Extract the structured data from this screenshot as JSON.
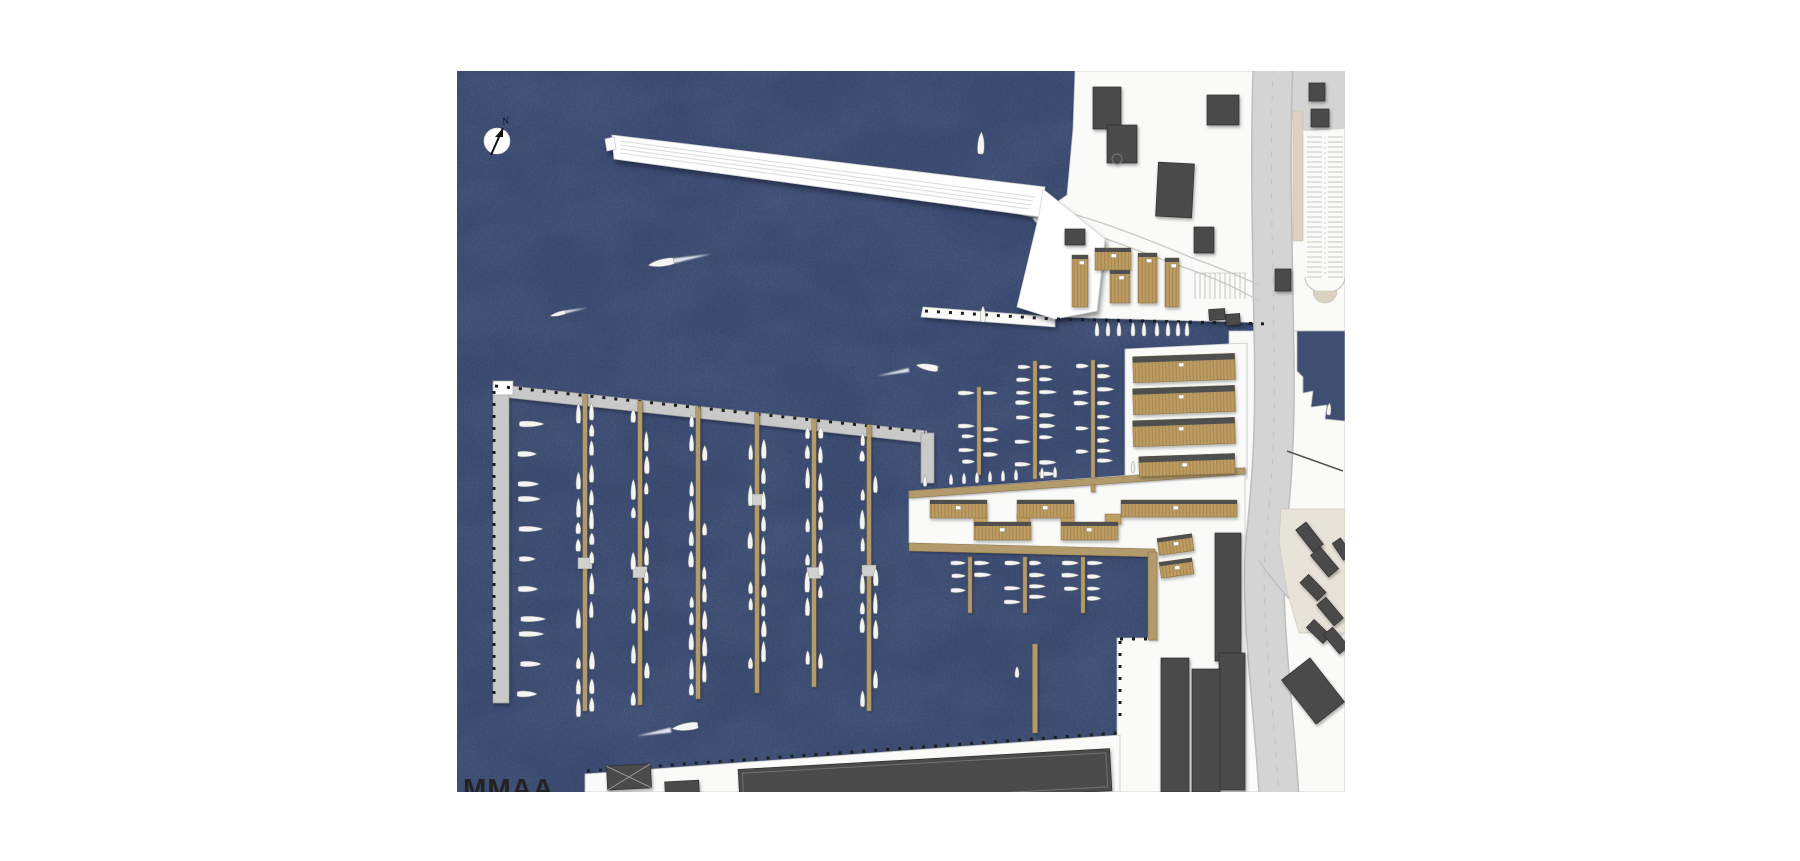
{
  "page": {
    "background": "#ffffff"
  },
  "plan": {
    "frame": {
      "left": 457,
      "top": 71,
      "width": 888,
      "height": 721
    },
    "logo": {
      "text": "MMAA"
    },
    "compass": {
      "label": "N"
    },
    "seed": 11,
    "colors": {
      "water": "#3e4f72",
      "land": "#fafaf8",
      "land_stroke": "#c6c6c6",
      "road": "#d4d4d4",
      "road_casing": "#bdbdbd",
      "lane": "#c8c8c8",
      "beige": "#dbd2c2",
      "plaza": "#e8e3d9",
      "dark": "#4a4a4a",
      "dark_stroke": "#2e2e2e",
      "wood": "#b29a6a",
      "wood_stroke": "#8a7349",
      "shed": "#bd9d62",
      "shed_top": "#4f4f4f",
      "gray_pier": "#c9c9c9",
      "gray_pier_stroke": "#9a9a9a",
      "boat": "#f4f4f2",
      "boat_stroke": "#8f8f8f",
      "platform": "#d0d0ce",
      "tick": "#1d1d1d",
      "white": "#ffffff"
    },
    "landforms": [
      {
        "name": "land-top-right",
        "points": [
          [
            618,
            0
          ],
          [
            888,
            0
          ],
          [
            888,
            262
          ],
          [
            816,
            262
          ],
          [
            816,
            252
          ],
          [
            598,
            246
          ],
          [
            590,
            234
          ],
          [
            590,
            200
          ],
          [
            602,
            176
          ],
          [
            576,
            148
          ],
          [
            610,
            124
          ],
          [
            616,
            58
          ]
        ]
      },
      {
        "name": "land-right-strip",
        "points": [
          [
            772,
            260
          ],
          [
            888,
            260
          ],
          [
            888,
            721
          ],
          [
            772,
            721
          ]
        ]
      },
      {
        "name": "land-shed-strip",
        "points": [
          [
            668,
            278
          ],
          [
            790,
            272
          ],
          [
            790,
            408
          ],
          [
            668,
            414
          ]
        ]
      },
      {
        "name": "land-peninsula",
        "points": [
          [
            452,
            420
          ],
          [
            788,
            396
          ],
          [
            788,
            721
          ],
          [
            660,
            721
          ],
          [
            660,
            567
          ],
          [
            698,
            567
          ],
          [
            698,
            481
          ],
          [
            452,
            472
          ]
        ]
      },
      {
        "name": "land-bottom-quay",
        "points": [
          [
            128,
            703
          ],
          [
            663,
            664
          ],
          [
            663,
            721
          ],
          [
            128,
            721
          ]
        ]
      },
      {
        "name": "quay-strip",
        "points": [
          [
            466,
            236
          ],
          [
            598,
            246
          ],
          [
            598,
            256
          ],
          [
            464,
            246
          ]
        ]
      }
    ],
    "water_inlet": {
      "points": [
        [
          840,
          260
        ],
        [
          888,
          260
        ],
        [
          888,
          350
        ],
        [
          868,
          348
        ],
        [
          870,
          334
        ],
        [
          854,
          336
        ],
        [
          856,
          320
        ],
        [
          846,
          322
        ],
        [
          846,
          306
        ],
        [
          840,
          300
        ]
      ]
    },
    "white_pier": {
      "bar": [
        [
          155,
          64
        ],
        [
          588,
          116
        ],
        [
          584,
          146
        ],
        [
          157,
          88
        ]
      ],
      "wedge": [
        [
          586,
          118
        ],
        [
          648,
          168
        ],
        [
          640,
          240
        ],
        [
          598,
          248
        ],
        [
          560,
          236
        ],
        [
          582,
          144
        ]
      ],
      "tip_notch": [
        [
          148,
          68
        ],
        [
          157,
          66
        ],
        [
          159,
          78
        ],
        [
          150,
          80
        ]
      ],
      "lanes": [
        [
          163,
          70,
          578,
          126
        ],
        [
          163,
          74,
          576,
          130
        ],
        [
          163,
          78,
          574,
          134
        ],
        [
          163,
          82,
          572,
          138
        ]
      ],
      "connector_lanes": [
        "M 560,130 C 620,140 680,164 733,186 C 760,196 785,206 802,214",
        "M 556,142 C 615,152 675,178 726,196 C 755,206 782,218 802,230"
      ]
    },
    "gray_breakwater": {
      "header": [
        [
          36,
          313
        ],
        [
          470,
          360
        ],
        [
          470,
          372
        ],
        [
          36,
          325
        ]
      ],
      "vertical": [
        [
          36,
          313
        ],
        [
          52,
          313
        ],
        [
          52,
          632
        ],
        [
          36,
          632
        ]
      ],
      "stub": [
        [
          464,
          362
        ],
        [
          477,
          362
        ],
        [
          477,
          412
        ],
        [
          464,
          412
        ]
      ],
      "cap": [
        [
          36,
          310
        ],
        [
          56,
          310
        ],
        [
          56,
          324
        ],
        [
          36,
          324
        ]
      ]
    },
    "quay_ticks": [
      [
        38,
        315,
        468,
        361
      ],
      [
        37,
        320,
        37,
        628
      ],
      [
        600,
        248,
        814,
        253
      ],
      [
        130,
        700,
        660,
        662
      ],
      [
        468,
        240,
        596,
        248
      ],
      [
        663,
        568,
        700,
        568
      ],
      [
        663,
        570,
        663,
        650
      ]
    ],
    "roads": {
      "main": "M 816,-4 C 813,80 815,160 817,270 C 819,368 814,420 808,478 C 804,545 816,630 822,724",
      "main_width": 38,
      "branch": "M 812,482 C 838,520 862,542 890,558",
      "branch_width": 24,
      "top_wedge": [
        [
          796,
          0
        ],
        [
          888,
          0
        ],
        [
          888,
          58
        ],
        [
          848,
          60
        ],
        [
          812,
          26
        ]
      ],
      "platform": {
        "x": 836,
        "y": 40,
        "w": 10,
        "h": 130
      },
      "plaza": [
        [
          824,
          438
        ],
        [
          888,
          438
        ],
        [
          888,
          562
        ],
        [
          842,
          562
        ],
        [
          830,
          520
        ],
        [
          822,
          470
        ]
      ],
      "plaza_edge": [
        830,
        380,
        886,
        400
      ],
      "parking": {
        "x": 848,
        "w": 40,
        "y1": 66,
        "y2": 206,
        "step": 5,
        "end_cy": 220,
        "end_r": 12
      },
      "parking_small": {
        "x1": 738,
        "x2": 790,
        "y1": 202,
        "y2": 228,
        "step": 5
      }
    },
    "buildings_dark": [
      {
        "x": 636,
        "y": 16,
        "w": 28,
        "h": 42,
        "r": 0
      },
      {
        "x": 650,
        "y": 54,
        "w": 30,
        "h": 38,
        "r": 0
      },
      {
        "x": 750,
        "y": 24,
        "w": 32,
        "h": 30,
        "r": 0
      },
      {
        "x": 852,
        "y": 12,
        "w": 16,
        "h": 18,
        "r": 0
      },
      {
        "x": 854,
        "y": 38,
        "w": 18,
        "h": 18,
        "r": 0
      },
      {
        "x": 700,
        "y": 92,
        "w": 36,
        "h": 54,
        "r": 3
      },
      {
        "x": 737,
        "y": 156,
        "w": 20,
        "h": 26,
        "r": 0
      },
      {
        "x": 608,
        "y": 158,
        "w": 20,
        "h": 16,
        "r": 0
      },
      {
        "x": 818,
        "y": 198,
        "w": 16,
        "h": 22,
        "r": 0
      },
      {
        "x": 752,
        "y": 238,
        "w": 16,
        "h": 11,
        "r": -4
      },
      {
        "x": 769,
        "y": 243,
        "w": 14,
        "h": 11,
        "r": -4
      },
      {
        "x": 758,
        "y": 462,
        "w": 26,
        "h": 128,
        "r": 0
      },
      {
        "x": 762,
        "y": 582,
        "w": 26,
        "h": 137,
        "r": 0
      },
      {
        "x": 704,
        "y": 587,
        "w": 28,
        "h": 134,
        "r": 0
      },
      {
        "x": 735,
        "y": 598,
        "w": 28,
        "h": 123,
        "r": 0
      },
      {
        "x": 846,
        "y": 452,
        "w": 13,
        "h": 28,
        "r": -38
      },
      {
        "x": 861,
        "y": 477,
        "w": 13,
        "h": 28,
        "r": -40
      },
      {
        "x": 850,
        "y": 504,
        "w": 12,
        "h": 25,
        "r": -44
      },
      {
        "x": 867,
        "y": 527,
        "w": 12,
        "h": 27,
        "r": -40
      },
      {
        "x": 856,
        "y": 549,
        "w": 11,
        "h": 23,
        "r": -46
      },
      {
        "x": 873,
        "y": 557,
        "w": 12,
        "h": 25,
        "r": -40
      },
      {
        "x": 880,
        "y": 468,
        "w": 10,
        "h": 20,
        "r": -34
      },
      {
        "x": 838,
        "y": 592,
        "w": 36,
        "h": 56,
        "r": -38
      },
      {
        "x": 208,
        "y": 710,
        "w": 34,
        "h": 12,
        "r": -3
      }
    ],
    "building_cross": {
      "x": 150,
      "y": 694,
      "w": 44,
      "h": 24,
      "r": -3
    },
    "building_big_shed": {
      "x": 282,
      "y": 688,
      "w": 372,
      "h": 42,
      "r": -3.2
    },
    "building_detail_circle": {
      "cx": 660,
      "cy": 88,
      "r": 5
    },
    "quay_sheds": [
      {
        "x": 615,
        "y": 184,
        "w": 16,
        "h": 52,
        "r": 0
      },
      {
        "x": 638,
        "y": 177,
        "w": 36,
        "h": 22,
        "r": 0
      },
      {
        "x": 653,
        "y": 199,
        "w": 20,
        "h": 33,
        "r": 0
      },
      {
        "x": 681,
        "y": 182,
        "w": 19,
        "h": 50,
        "r": 0
      },
      {
        "x": 708,
        "y": 187,
        "w": 14,
        "h": 49,
        "r": 0
      }
    ],
    "quay_boats": {
      "xs": [
        640,
        651,
        662,
        676,
        687,
        700,
        711,
        721,
        730
      ],
      "cy": 258,
      "len": 14,
      "wid": 5
    },
    "shed_rows": [
      {
        "x": 676,
        "y": 284,
        "w": 102,
        "h": 26,
        "r": -2
      },
      {
        "x": 676,
        "y": 316,
        "w": 102,
        "h": 26,
        "r": -2
      },
      {
        "x": 676,
        "y": 348,
        "w": 102,
        "h": 26,
        "r": -2
      },
      {
        "x": 682,
        "y": 384,
        "w": 96,
        "h": 20,
        "r": -2
      }
    ],
    "zigzag": {
      "segments": [
        {
          "x": 473,
          "y": 429,
          "w": 57,
          "h": 18
        },
        {
          "x": 560,
          "y": 429,
          "w": 57,
          "h": 18
        },
        {
          "x": 517,
          "y": 451,
          "w": 57,
          "h": 18
        },
        {
          "x": 604,
          "y": 451,
          "w": 57,
          "h": 18
        },
        {
          "x": 664,
          "y": 429,
          "w": 116,
          "h": 17
        }
      ],
      "connectors": [
        {
          "x": 517,
          "y": 443,
          "w": 13,
          "h": 10
        },
        {
          "x": 560,
          "y": 443,
          "w": 13,
          "h": 10
        },
        {
          "x": 604,
          "y": 443,
          "w": 13,
          "h": 10
        },
        {
          "x": 648,
          "y": 443,
          "w": 16,
          "h": 10
        }
      ]
    },
    "small_sheds": [
      {
        "x": 701,
        "y": 465,
        "w": 35,
        "h": 17,
        "r": -8
      },
      {
        "x": 703,
        "y": 489,
        "w": 33,
        "h": 16,
        "r": -8
      }
    ],
    "piers": {
      "width": 4.5,
      "main": [
        {
          "x": 128,
          "y1": 324,
          "y2": 640
        },
        {
          "x": 183,
          "y1": 330,
          "y2": 634
        },
        {
          "x": 241,
          "y1": 336,
          "y2": 628
        },
        {
          "x": 300,
          "y1": 342,
          "y2": 622
        },
        {
          "x": 357,
          "y1": 348,
          "y2": 616
        },
        {
          "x": 412,
          "y1": 354,
          "y2": 640
        }
      ],
      "basin2": [
        {
          "x": 522,
          "y1": 316,
          "y2": 404
        },
        {
          "x": 578,
          "y1": 290,
          "y2": 408
        },
        {
          "x": 636,
          "y1": 289,
          "y2": 421
        }
      ],
      "lower": [
        {
          "x": 513,
          "y1": 486,
          "y2": 542
        },
        {
          "x": 568,
          "y1": 486,
          "y2": 542
        },
        {
          "x": 626,
          "y1": 486,
          "y2": 542
        }
      ],
      "lone": {
        "x": 578,
        "y1": 573,
        "y2": 662
      },
      "boardwalk_upper": [
        [
          452,
          420
        ],
        [
          788,
          397
        ],
        [
          788,
          403
        ],
        [
          452,
          427
        ]
      ],
      "boardwalk_lower": [
        [
          452,
          472
        ],
        [
          698,
          478
        ],
        [
          698,
          486
        ],
        [
          452,
          480
        ]
      ],
      "quay_vertical": [
        [
          691,
          481
        ],
        [
          700,
          481
        ],
        [
          700,
          569
        ],
        [
          691,
          569
        ]
      ]
    },
    "boardwalk_boats": {
      "x1": 468,
      "x2": 700,
      "step": 13,
      "len": 11,
      "wid": 4.5
    },
    "breakwater_boats": {
      "x": 60,
      "y1": 338,
      "y2": 626,
      "step": 15
    },
    "boats_free": [
      {
        "cx": 204,
        "cy": 192,
        "len": 26,
        "wid": 9,
        "rot": -100
      },
      {
        "cx": 101,
        "cy": 243,
        "len": 16,
        "wid": 5,
        "rot": -105
      },
      {
        "cx": 524,
        "cy": 72,
        "len": 22,
        "wid": 8,
        "rot": 2
      },
      {
        "cx": 526,
        "cy": 243,
        "len": 16,
        "wid": 6,
        "rot": 0
      },
      {
        "cx": 470,
        "cy": 296,
        "len": 22,
        "wid": 8,
        "rot": -80
      },
      {
        "cx": 228,
        "cy": 656,
        "len": 26,
        "wid": 9,
        "rot": -98
      },
      {
        "cx": 872,
        "cy": 338,
        "len": 12,
        "wid": 5,
        "rot": 5
      },
      {
        "cx": 560,
        "cy": 601,
        "len": 11,
        "wid": 5,
        "rot": 0
      }
    ],
    "wakes": [
      {
        "x1": 216,
        "y1": 190,
        "x2": 254,
        "y2": 183,
        "w": 5
      },
      {
        "x1": 108,
        "y1": 241,
        "x2": 130,
        "y2": 237,
        "w": 3
      },
      {
        "x1": 452,
        "y1": 299,
        "x2": 420,
        "y2": 305,
        "w": 4
      },
      {
        "x1": 214,
        "y1": 659,
        "x2": 180,
        "y2": 665,
        "w": 5
      }
    ]
  }
}
